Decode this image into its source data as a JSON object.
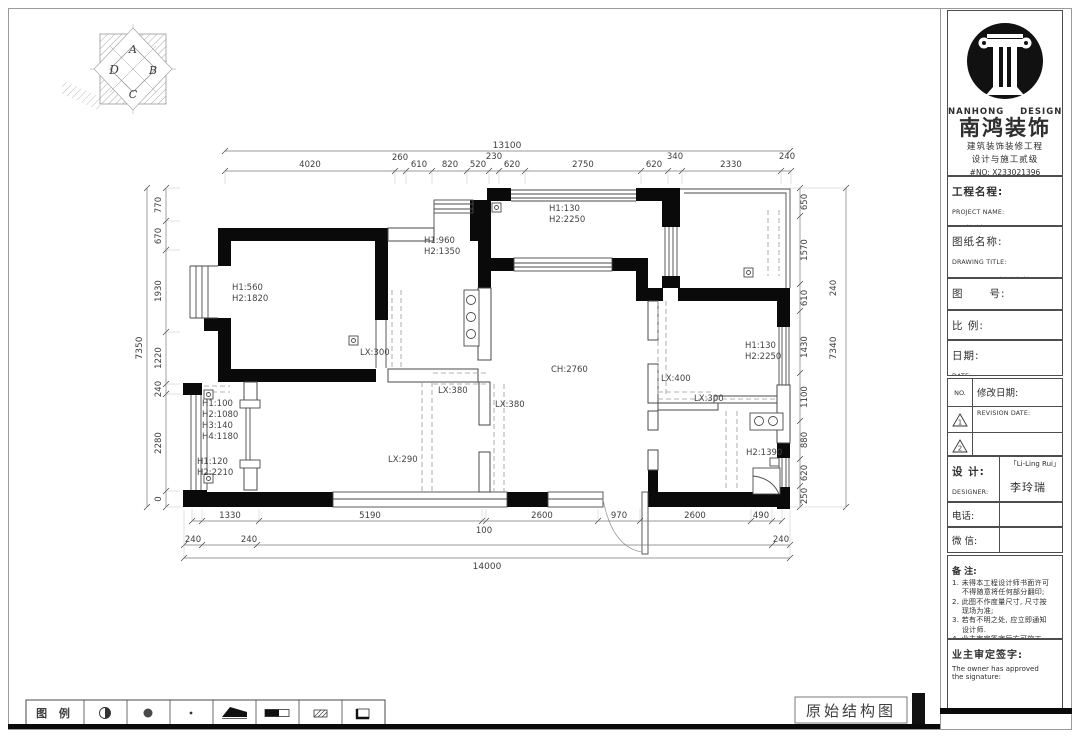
{
  "colors": {
    "wall": "#0a0a0a",
    "line": "#4a4a4a",
    "dim": "#3f3f3f",
    "dash": "#9a9a9a"
  },
  "compass": {
    "letters": [
      "A",
      "B",
      "C",
      "D"
    ]
  },
  "plan": {
    "dims": {
      "top_total": "13100",
      "top": [
        "4020",
        "260",
        "610",
        "820",
        "520",
        "230",
        "620",
        "2750",
        "620",
        "340",
        "2330",
        "240"
      ],
      "left_total": "7350",
      "left": [
        "770",
        "670",
        "1930",
        "1220",
        "240",
        "2280",
        "0"
      ],
      "right": [
        "650",
        "1570",
        "610",
        "1430",
        "1100",
        "880",
        "620",
        "250"
      ],
      "right_outer": [
        "240",
        "7340"
      ],
      "bottom": [
        "1330",
        "5190",
        "100",
        "2600",
        "970",
        "2600",
        "490"
      ],
      "bottom_row2": [
        "240",
        "240",
        "240"
      ],
      "bottom_total": "14000"
    },
    "labels": {
      "bed1": [
        "H1:560",
        "H2:1820"
      ],
      "mid_room": [
        "H1:960",
        "H2:1350"
      ],
      "balcony": [
        "H1:130",
        "H2:2250"
      ],
      "bed2": [
        "H1:130",
        "H2:2250"
      ],
      "left_window": [
        "H1:100",
        "H2:1080",
        "H3:140",
        "H4:1180"
      ],
      "left_window2": [
        "H1:120",
        "H2:2210"
      ],
      "bath": "H2:1390",
      "ceiling": "CH:2760",
      "lx": [
        "LX:300",
        "LX:380",
        "LX:380",
        "LX:290",
        "LX:400",
        "LX:300"
      ]
    }
  },
  "legend": {
    "label": "图 例"
  },
  "footer": {
    "title": "原始结构图"
  },
  "title_block": {
    "brand": {
      "en": "NANHONG    DESIGN",
      "cn": "南鸿装饰",
      "line1": "建筑装饰装修工程",
      "line2": "设计与施工贰级",
      "no": "#NO: X233021396"
    },
    "project": {
      "label_cn": "工程名程:",
      "label_en": "PROJECT NAME:",
      "value": "世茂西西湖"
    },
    "drawing_title": {
      "label_cn": "图纸名称:",
      "label_en": "DRAWING TITLE:",
      "value": "原始结构图"
    },
    "drawing_no": {
      "label_cn": "图      号:",
      "label_en": "DRAWING NO.:",
      "value": "P-01"
    },
    "scale": {
      "label_cn": "比 例:",
      "label_en": "SCALE:",
      "value": "1:60"
    },
    "date": {
      "label_cn": "日期:",
      "label_en": "DATE:"
    },
    "revision": {
      "no": "NO.",
      "label_cn": "修改日期:",
      "label_en": "REVISION DATE:",
      "rows": [
        "1",
        "2"
      ]
    },
    "designer": {
      "label_cn": "设  计:",
      "label_en": "DESIGNER:",
      "value_en": "「Li-Ling Rui」",
      "value_cn": "李玲瑞"
    },
    "tel": {
      "label_cn": "电话:",
      "label_en": "Tel::"
    },
    "wechat": {
      "label_cn": "微 信:",
      "label_en": "WeChat:"
    },
    "notes": {
      "label": "备  注:",
      "lines": [
        "1. 未得本工程设计师书面许可",
        "    不得随意将任何部分翻印;",
        "2. 此图不作度量尺寸, 尺寸按",
        "    现场为准;",
        "3. 若有不明之处, 应立即通知",
        "    设计师.",
        "4. 业主审定签字后方可施工."
      ],
      "footer": "本设计解释权归设计师所有."
    },
    "owner": {
      "label": "业主审定签字:",
      "en1": "The owner has approved",
      "en2": "the signature:"
    }
  }
}
